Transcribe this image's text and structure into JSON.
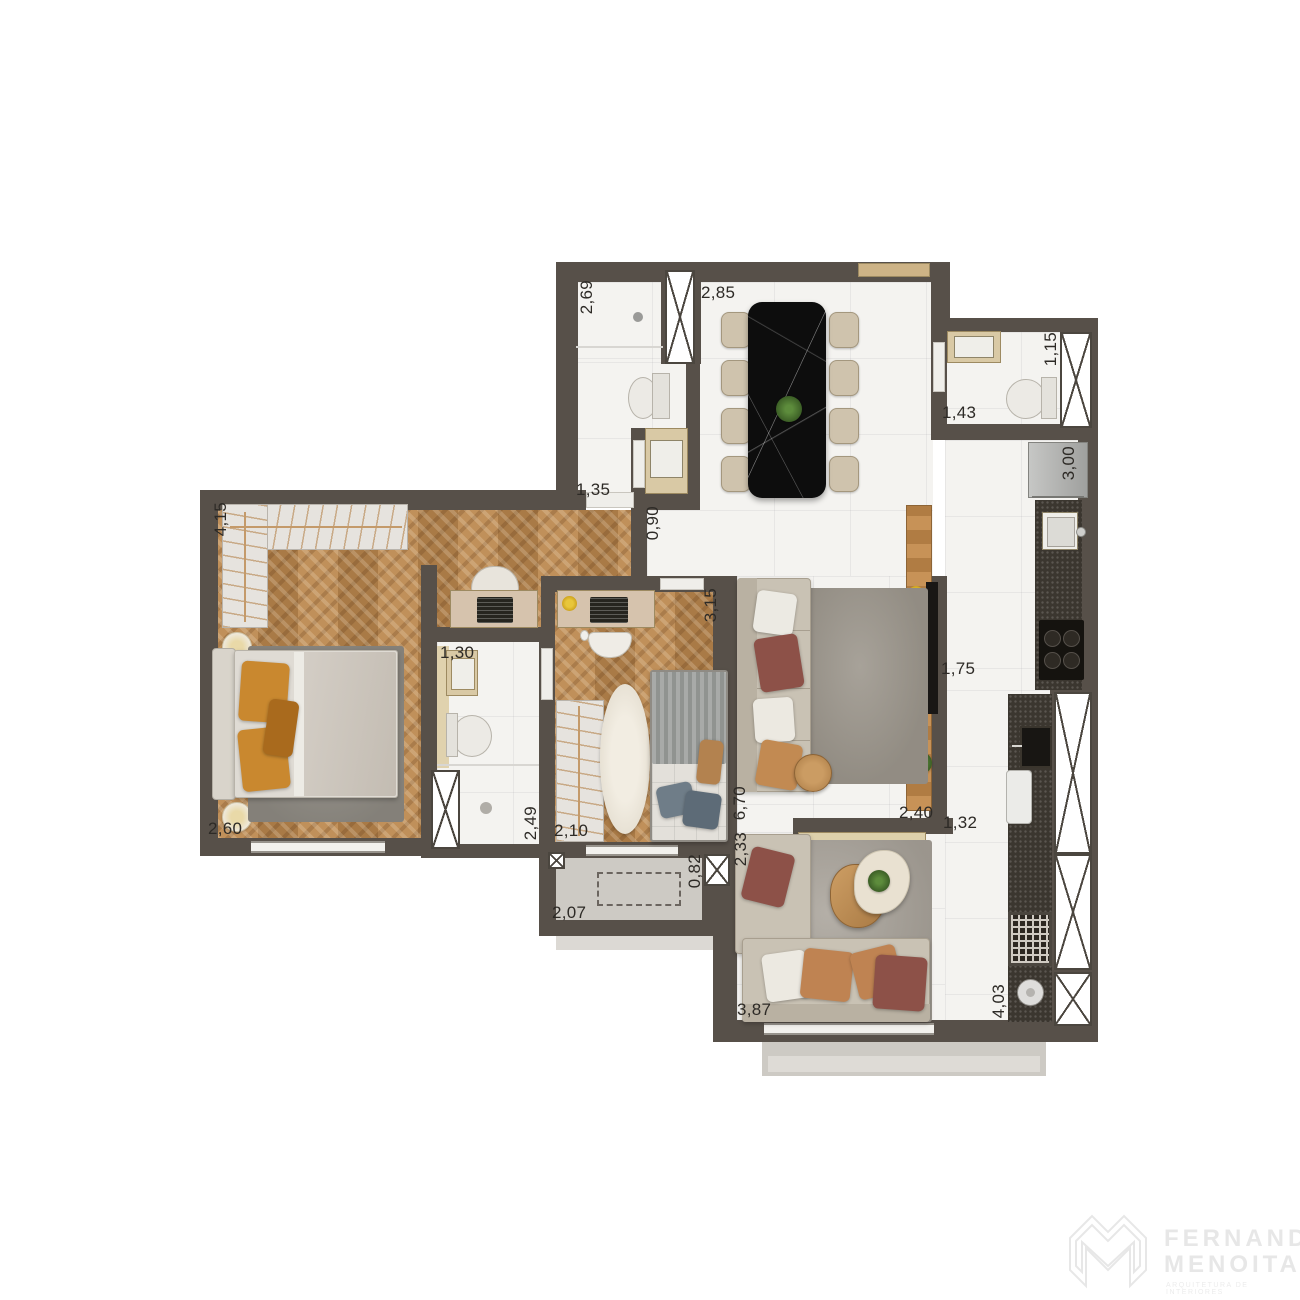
{
  "dimensions": {
    "v269": "2,69",
    "v285": "2,85",
    "v115": "1,15",
    "v143": "1,43",
    "v300": "3,00",
    "v135": "1,35",
    "v090": "0,90",
    "v415": "4,15",
    "v130": "1,30",
    "v315": "3,15",
    "v175": "1,75",
    "v260": "2,60",
    "v249": "2,49",
    "v210": "2,10",
    "v670": "6,70",
    "v240": "2,40",
    "v132": "1,32",
    "v233": "2,33",
    "v082": "0,82",
    "v207": "2,07",
    "v387": "3,87",
    "v403": "4,03"
  },
  "watermark": {
    "brand_line1": "FERNANDO",
    "brand_line2": "MENOITA",
    "tagline": "ARQUITETURA DE INTERIORES"
  },
  "colors": {
    "wall": "#575049",
    "wood_floor": "#b68852",
    "marble_floor": "#f4f3f0",
    "black_marble_table": "#0d0d0d",
    "granite_counter": "#3b362f",
    "accent_pillow_rust": "#8d5148",
    "accent_pillow_orange": "#c9882f"
  }
}
